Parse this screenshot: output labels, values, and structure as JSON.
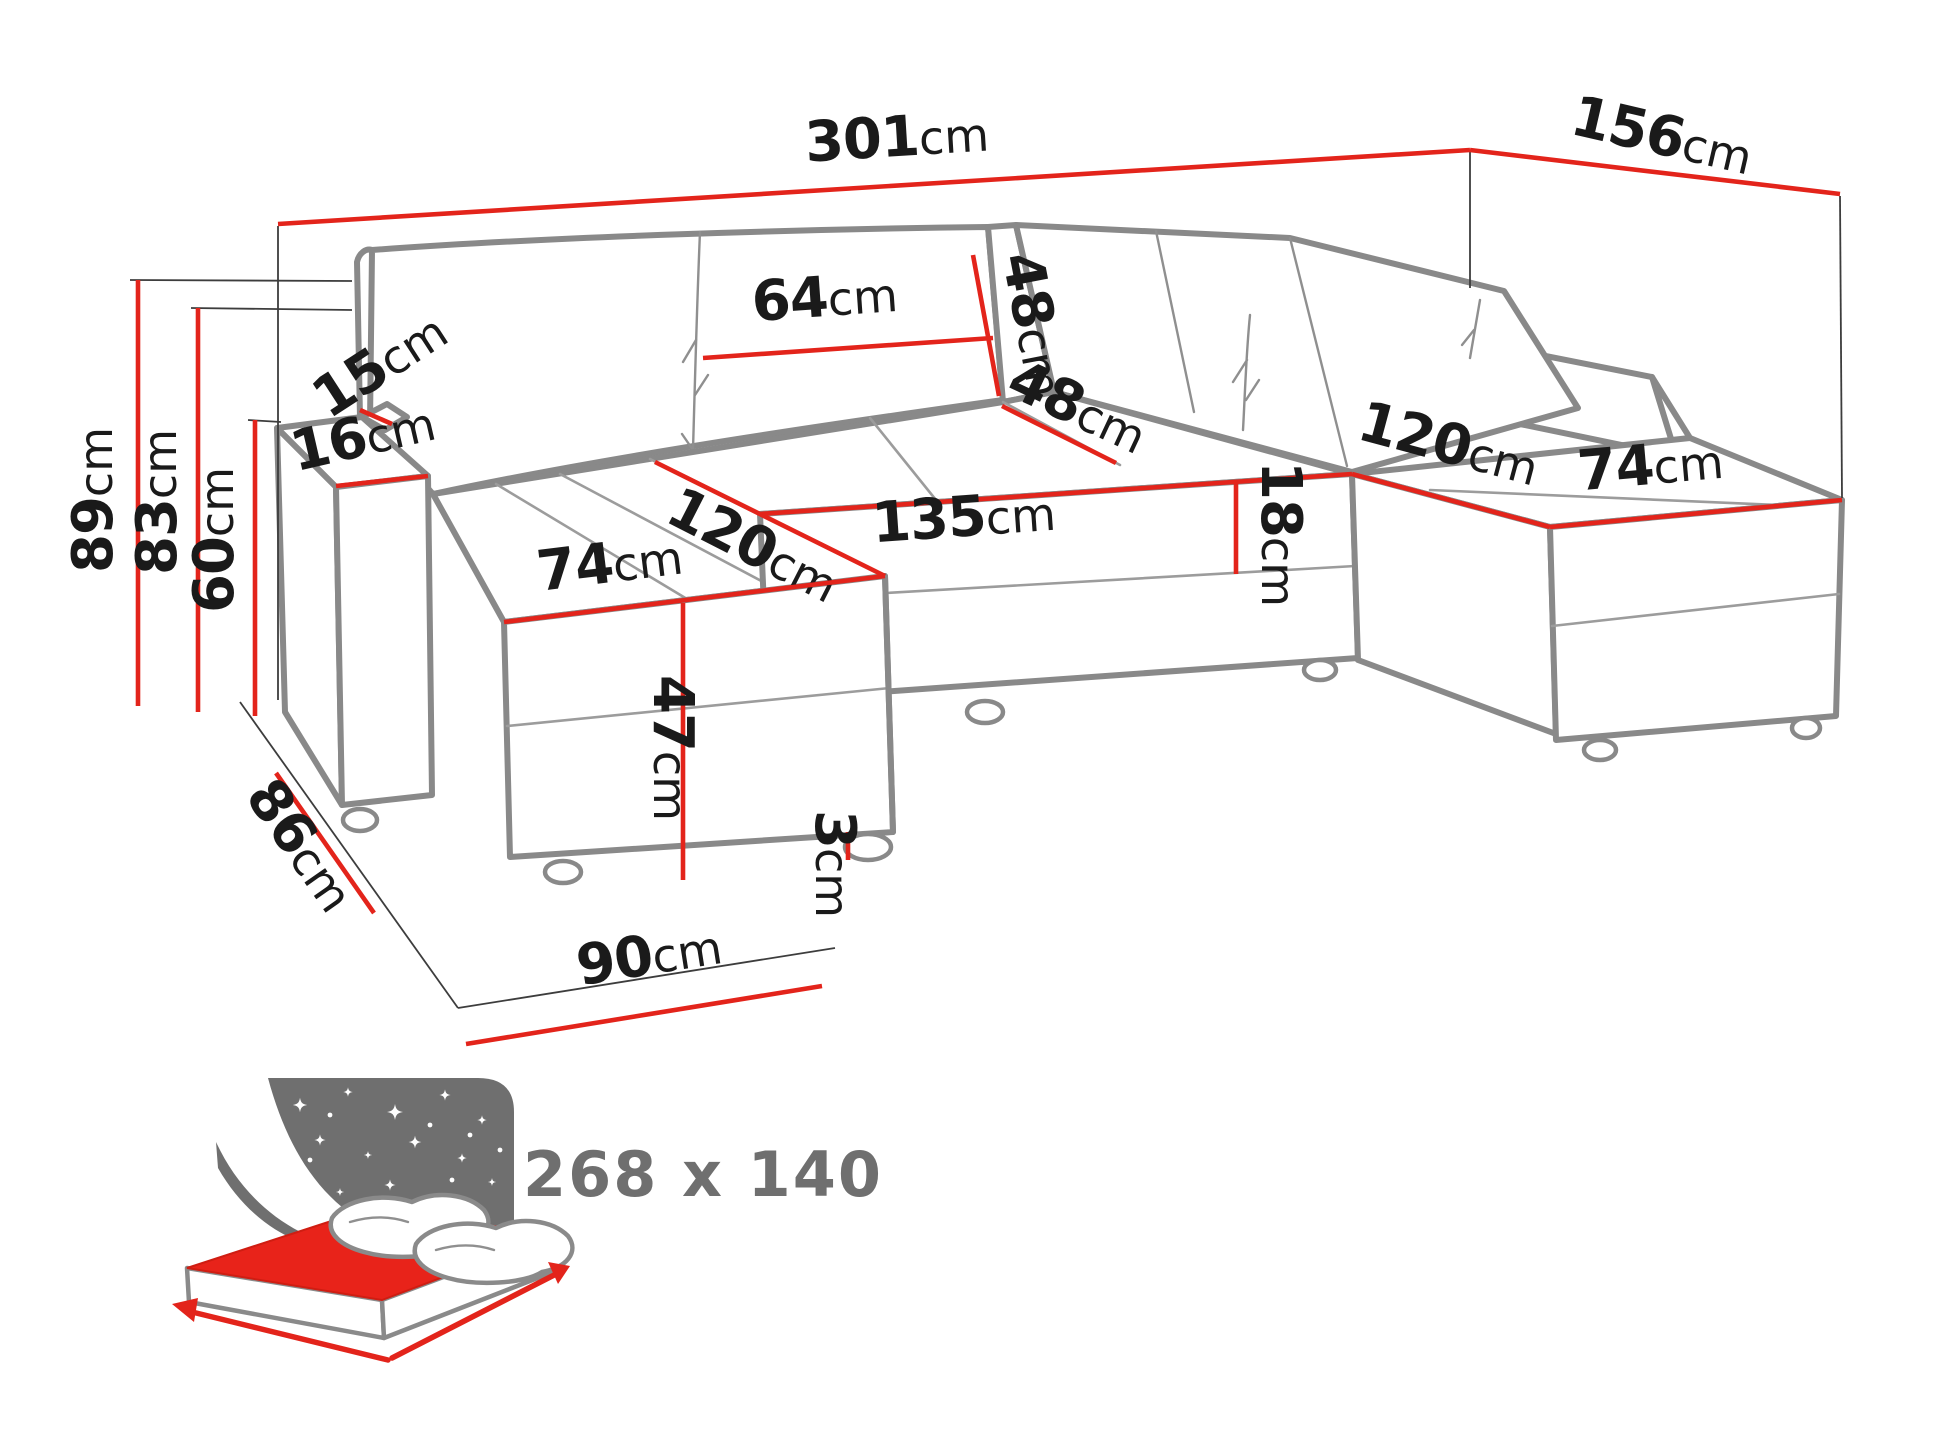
{
  "dims": {
    "width_overall": {
      "value": "301",
      "unit": "cm"
    },
    "depth_overall": {
      "value": "156",
      "unit": "cm"
    },
    "height_overall": {
      "value": "89",
      "unit": "cm"
    },
    "height_backrest": {
      "value": "83",
      "unit": "cm"
    },
    "height_armrest": {
      "value": "60",
      "unit": "cm"
    },
    "armrest_top_width": {
      "value": "15",
      "unit": "cm"
    },
    "armrest_width": {
      "value": "16",
      "unit": "cm"
    },
    "back_cushion_width": {
      "value": "64",
      "unit": "cm"
    },
    "back_cushion_height": {
      "value": "48",
      "unit": "cm"
    },
    "seat_back_depth": {
      "value": "48",
      "unit": "cm"
    },
    "chaise_length_left": {
      "value": "120",
      "unit": "cm"
    },
    "center_seat_width": {
      "value": "135",
      "unit": "cm"
    },
    "seat_cushion_thickness": {
      "value": "18",
      "unit": "cm"
    },
    "chaise_width_left": {
      "value": "74",
      "unit": "cm"
    },
    "seat_height": {
      "value": "47",
      "unit": "cm"
    },
    "leg_height": {
      "value": "3",
      "unit": "cm"
    },
    "chaise_footprint": {
      "value": "90",
      "unit": "cm"
    },
    "side_depth": {
      "value": "86",
      "unit": "cm"
    },
    "chaise_length_right": {
      "value": "120",
      "unit": "cm"
    },
    "chaise_width_right": {
      "value": "74",
      "unit": "cm"
    }
  },
  "sleeping_area": {
    "size": "268 x 140"
  },
  "colors": {
    "dimension_red": "#e3241b",
    "sketch_gray": "#898989",
    "label_black": "#1a1a1a",
    "icon_gray": "#6f6f6f",
    "size_text_gray": "#6f6f6f"
  }
}
